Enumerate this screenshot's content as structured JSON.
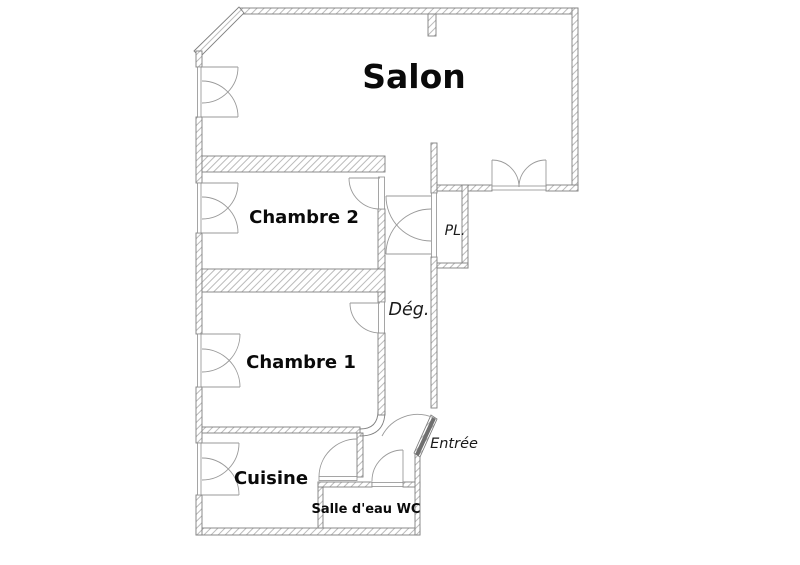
{
  "plan": {
    "type": "apartment-floor-plan",
    "rooms": [
      {
        "id": "salon",
        "label": "Salon"
      },
      {
        "id": "chambre2",
        "label": "Chambre 2"
      },
      {
        "id": "chambre1",
        "label": "Chambre 1"
      },
      {
        "id": "cuisine",
        "label": "Cuisine"
      },
      {
        "id": "salle_eau",
        "label": "Salle d'eau  WC"
      }
    ],
    "annotations": [
      {
        "id": "pl",
        "label": "PL."
      },
      {
        "id": "deg",
        "label": "Dég."
      },
      {
        "id": "entree",
        "label": "Entrée"
      }
    ]
  },
  "colors": {
    "background": "#ffffff",
    "wall_outline": "#7f7f7f",
    "hatch": "#b3b3b3",
    "door_swing": "#9a9a9a",
    "text": "#0a0a0a"
  }
}
